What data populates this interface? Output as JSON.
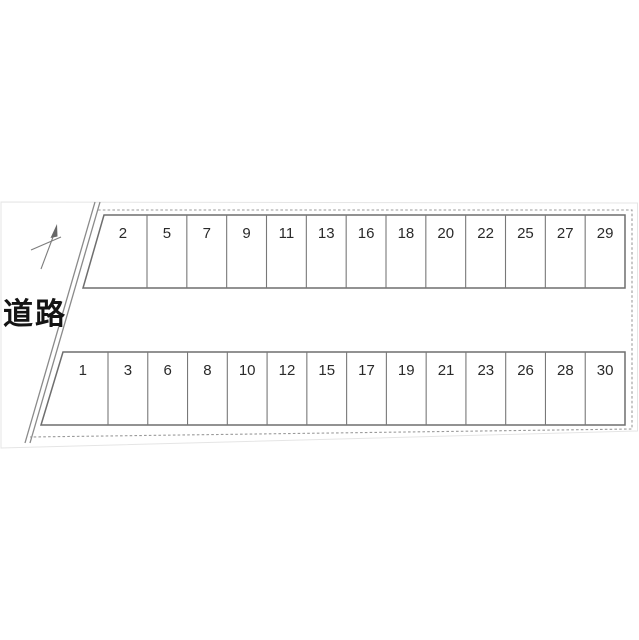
{
  "diagram": {
    "road_label": "道路",
    "rows": [
      {
        "name": "top",
        "spaces": [
          "2",
          "5",
          "7",
          "9",
          "11",
          "13",
          "16",
          "18",
          "20",
          "22",
          "25",
          "27",
          "29"
        ]
      },
      {
        "name": "bottom",
        "spaces": [
          "1",
          "3",
          "6",
          "8",
          "10",
          "12",
          "15",
          "17",
          "19",
          "21",
          "23",
          "26",
          "28",
          "30"
        ]
      }
    ],
    "colors": {
      "background": "#ffffff",
      "row_border": "#6e6e6e",
      "divider": "#787878",
      "boundary_dash": "#9a9a9a",
      "road_line": "#8a8a8a",
      "stall_number": "#2a2a2a",
      "road_text": "#141414",
      "photo_edge": "#e5e5e5"
    }
  }
}
